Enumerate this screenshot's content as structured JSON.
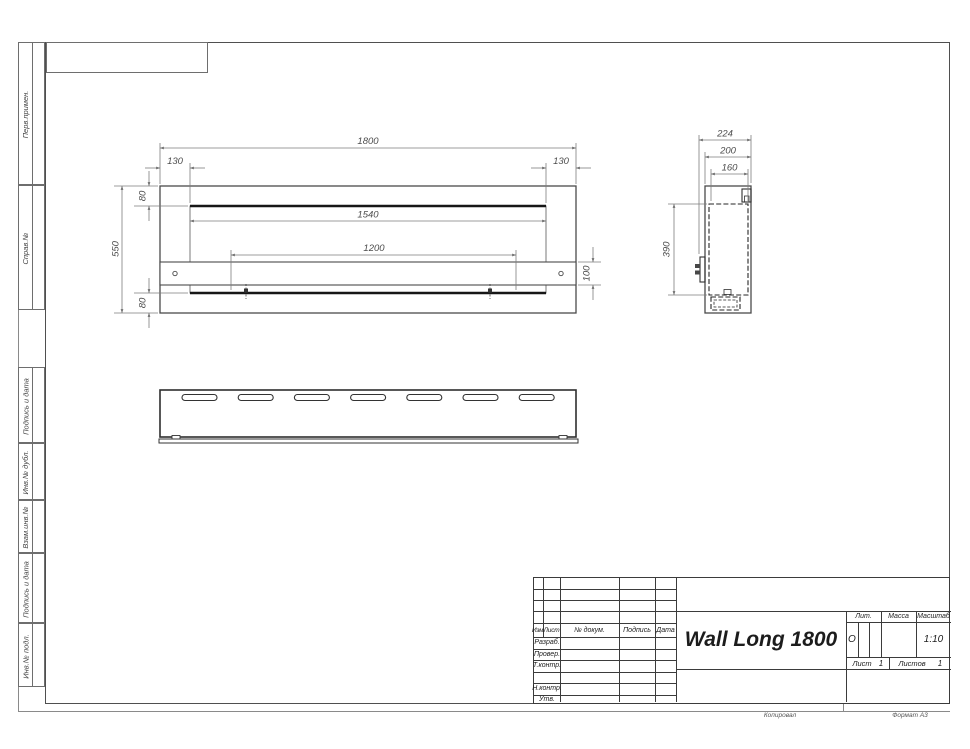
{
  "margin": {
    "labels": [
      "Перв.примен.",
      "Справ.№",
      "Подпись и дата",
      "Инв.№ дубл.",
      "Взам.инв.№",
      "Подпись и дата",
      "Инв.№ подл."
    ]
  },
  "views": {
    "front": {
      "width": "1800",
      "inset_left": "130",
      "inset_right": "130",
      "opening_width": "1540",
      "burner_span": "1200",
      "height": "550",
      "inset_top": "80",
      "inset_bottom": "80",
      "bracket_height": "100"
    },
    "side": {
      "depth_total": "224",
      "depth_body": "200",
      "depth_inner": "160",
      "insert_height": "390"
    }
  },
  "title_block": {
    "header_cells": [
      "Изм.",
      "Лист",
      "№ докум.",
      "Подпись",
      "Дата"
    ],
    "rows": [
      "Разраб.",
      "Провер.",
      "Т.контр.",
      "Н.контр.",
      "Утв."
    ],
    "doc_title": "Wall Long 1800",
    "lit_label": "Лит.",
    "lit_value": "О",
    "mass_label": "Масса",
    "scale_label": "Масштаб",
    "scale_value": "1:10",
    "sheet_label": "Лист",
    "sheet_value": "1",
    "sheets_label": "Листов",
    "sheets_value": "1"
  },
  "footer": {
    "copied": "Копировал",
    "format": "Формат А3"
  }
}
